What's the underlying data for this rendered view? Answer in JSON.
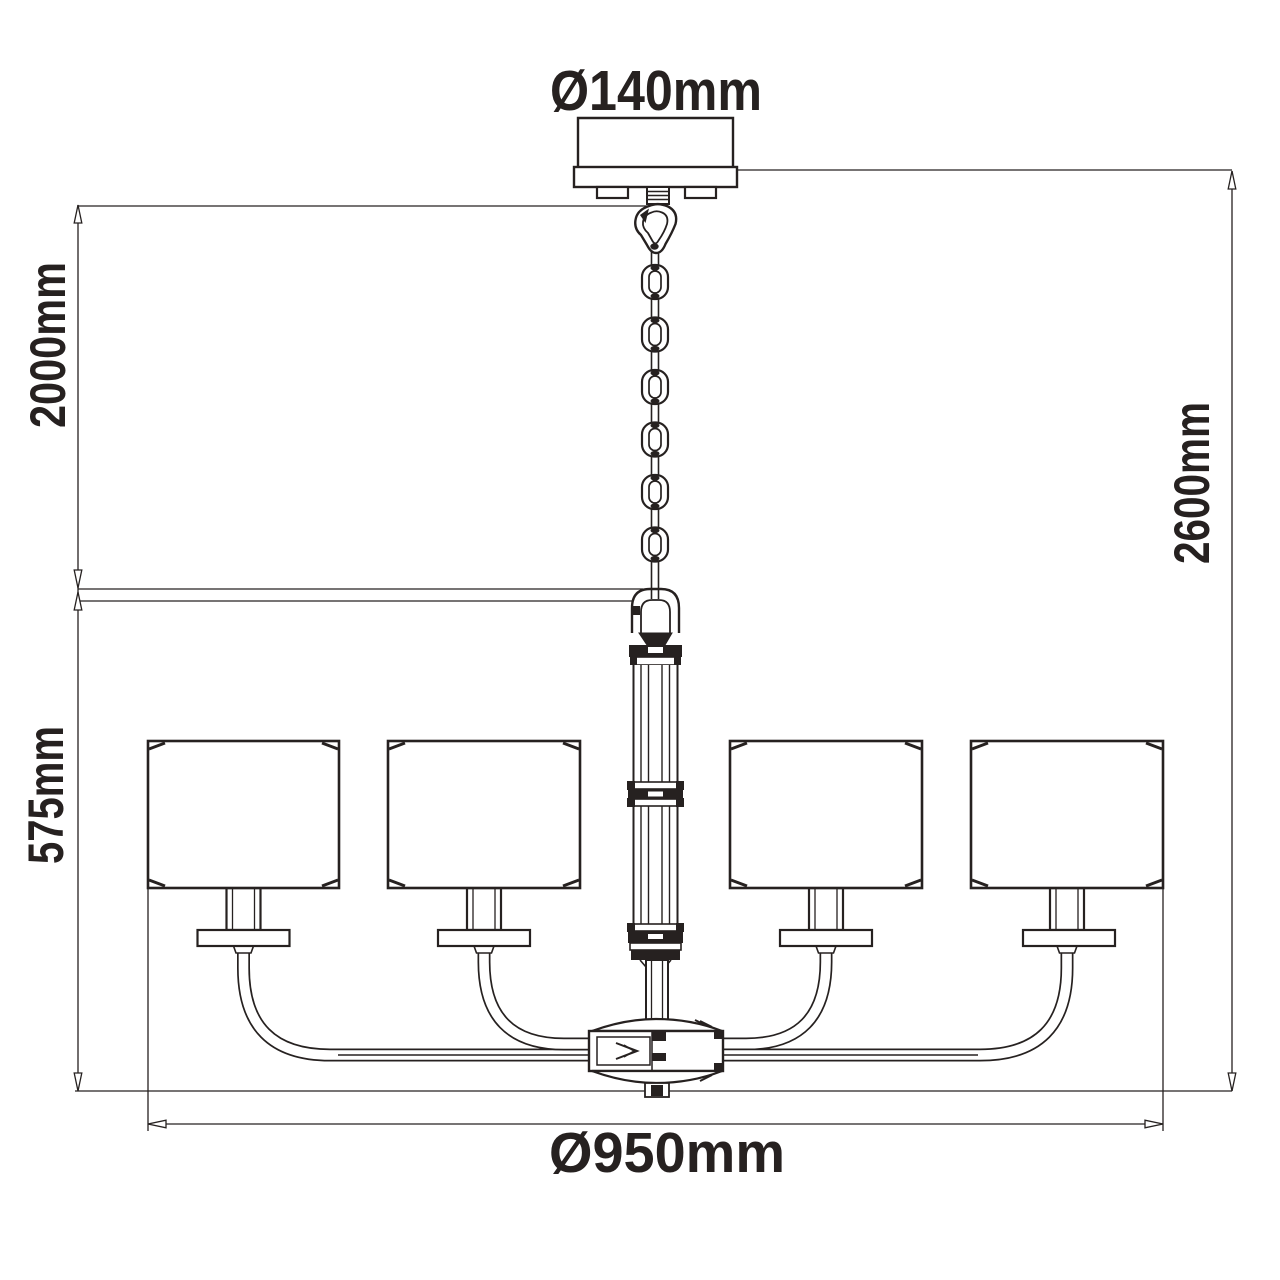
{
  "drawing": {
    "type": "chandelier-dimension-diagram",
    "background": "#ffffff",
    "line_color": "#262120",
    "labels": {
      "canopy_diameter": "Ø140mm",
      "chain_drop": "2000mm",
      "overall_height": "2600mm",
      "body_height": "575mm",
      "body_diameter": "Ø950mm"
    },
    "counts": {
      "shades": 4,
      "chain_links": 6,
      "arms": 4
    }
  }
}
